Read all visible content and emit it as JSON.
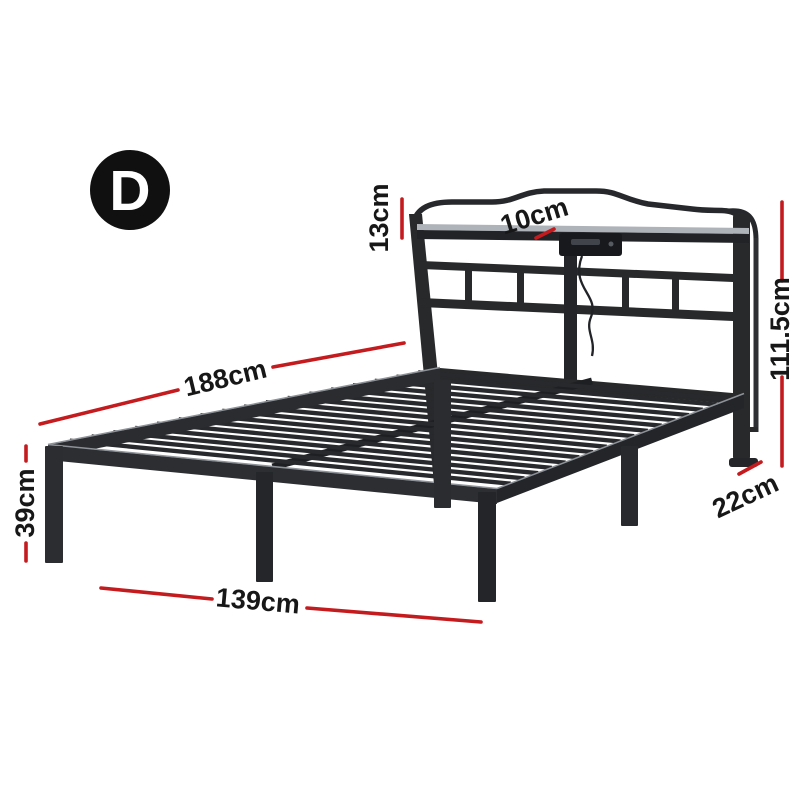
{
  "diagram": {
    "badge": {
      "letter": "D"
    },
    "dimensions": [
      {
        "id": "headboard-top-height",
        "label": "13cm"
      },
      {
        "id": "shelf-depth",
        "label": "10cm"
      },
      {
        "id": "headboard-height",
        "label": "111.5cm"
      },
      {
        "id": "bed-length",
        "label": "188cm"
      },
      {
        "id": "platform-height",
        "label": "39cm"
      },
      {
        "id": "headboard-leg-height",
        "label": "22cm"
      },
      {
        "id": "bed-width",
        "label": "139cm"
      }
    ],
    "colors": {
      "dimension_line": "#c41b1e",
      "label_text": "#171717",
      "frame": "#27292b",
      "badge_bg": "#101010",
      "badge_text": "#ffffff",
      "background": "#ffffff"
    }
  }
}
